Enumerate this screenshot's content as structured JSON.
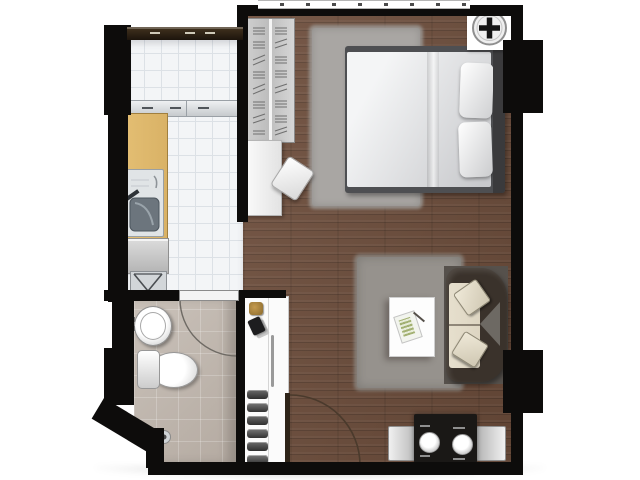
{
  "meta": {
    "kind": "apartment-floor-plan",
    "visible_text": "none",
    "orientation": "top-down"
  },
  "colors": {
    "wall": "#0d0c0b",
    "wood_floor": "#6d4d3b",
    "kitchen_tile": "#f3f5f7",
    "kitchen_tile_line": "#dce1e6",
    "bathroom_tile": "#b4aaa1",
    "counter_wood": "#d9b266",
    "bedroom_rug": "#a9a6a3",
    "living_rug": "#96928d",
    "sofa_base": "#56514c",
    "sofa_dark": "#3a322b",
    "sofa_cream": "#ddd5c2",
    "bed_frame": "#4e4f52",
    "mattress": "#e6e7e9",
    "dining_table": "#1a1816",
    "chair_gray": "#d3d3d3",
    "cabinet_white": "#fbfbfb",
    "door_leaf": "#2e2418",
    "arc_line": "#4a3a2c"
  },
  "rooms": [
    {
      "id": "bedroom-living",
      "label": "bedroom and living area",
      "floor": "wood-planks"
    },
    {
      "id": "kitchen",
      "label": "kitchen",
      "floor": "white-tile"
    },
    {
      "id": "bathroom",
      "label": "bathroom",
      "floor": "beige-tile"
    }
  ],
  "furniture": [
    {
      "room": "bedroom",
      "item": "wardrobe-with-hanging-clothes"
    },
    {
      "room": "bedroom",
      "item": "double-bed-with-two-pillows"
    },
    {
      "room": "bedroom",
      "item": "shag-rug"
    },
    {
      "room": "bedroom",
      "item": "desk"
    },
    {
      "room": "bedroom",
      "item": "desk-chair"
    },
    {
      "room": "bedroom",
      "item": "ceiling-fan-symbol"
    },
    {
      "room": "living",
      "item": "curved-sofa-with-cream-cushions"
    },
    {
      "room": "living",
      "item": "coffee-table-with-magazine"
    },
    {
      "room": "living",
      "item": "shag-rug"
    },
    {
      "room": "living",
      "item": "dining-table-two-place-settings"
    },
    {
      "room": "living",
      "item": "two-dining-chairs"
    },
    {
      "room": "living",
      "item": "entrance-door-swing"
    },
    {
      "room": "kitchen",
      "item": "wood-counter-with-sink"
    },
    {
      "room": "kitchen",
      "item": "washing-machine"
    },
    {
      "room": "kitchen",
      "item": "vent-shaft-box"
    },
    {
      "room": "kitchen",
      "item": "upper-counter-sliding-unit"
    },
    {
      "room": "bathroom",
      "item": "washbasin"
    },
    {
      "room": "bathroom",
      "item": "toilet"
    },
    {
      "room": "bathroom",
      "item": "hand-shower"
    },
    {
      "room": "bathroom",
      "item": "door-swing"
    },
    {
      "room": "hallway",
      "item": "shoe-cabinet-with-accessories"
    }
  ]
}
